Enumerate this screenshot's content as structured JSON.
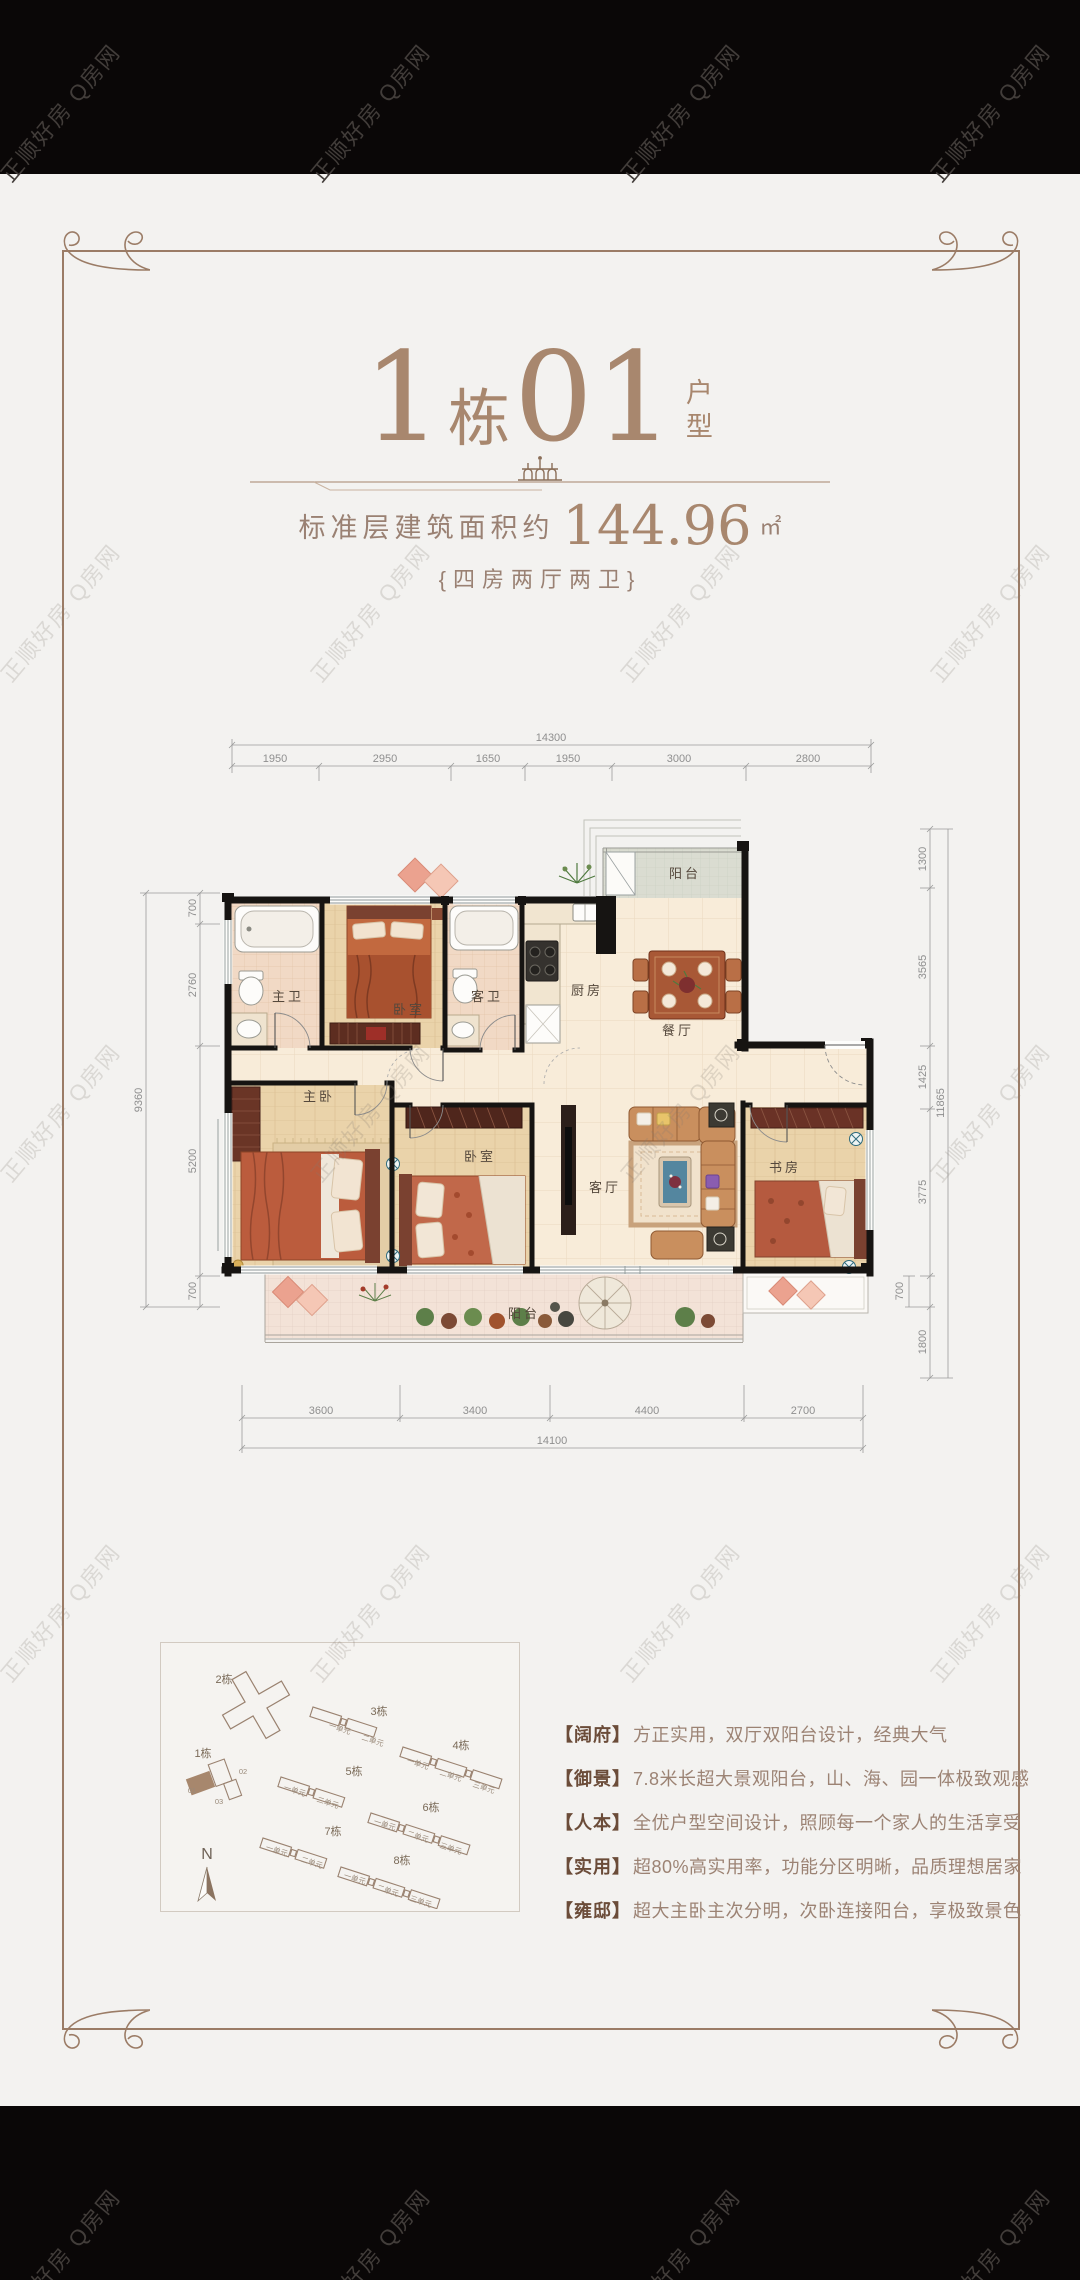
{
  "watermark": {
    "text": "正顺好房  Q房网"
  },
  "header": {
    "big1": "1",
    "unit_char": "栋",
    "big2": "01",
    "side_label": "户型",
    "area_prefix": "标准层建筑面积约",
    "area_value": "144.96",
    "area_unit": "㎡",
    "layout": "{四房两厅两卫}"
  },
  "floorplan": {
    "rooms": {
      "balcony_top": "阳台",
      "master_bath": "主卫",
      "bedroom2": "卧室",
      "guest_bath": "客卫",
      "kitchen": "厨房",
      "dining": "餐厅",
      "master_bedroom": "主卧",
      "bedroom3": "卧室",
      "living": "客厅",
      "study": "书房",
      "balcony_bottom": "阳台"
    },
    "dims_top": {
      "total": "14300",
      "segments": [
        "1950",
        "2950",
        "1650",
        "1950",
        "3000",
        "2800"
      ]
    },
    "dims_bottom": {
      "total": "14100",
      "segments": [
        "3600",
        "3400",
        "4400",
        "2700"
      ]
    },
    "dims_left": {
      "total": "9360",
      "segments": [
        "700",
        "2760",
        "5200",
        "700"
      ]
    },
    "dims_right": {
      "total": "11865",
      "segments": [
        "1300",
        "3565",
        "1425",
        "3775",
        "700",
        "1800"
      ]
    }
  },
  "siteplan": {
    "compass": "N",
    "buildings": [
      {
        "name": "2栋",
        "units": []
      },
      {
        "name": "1栋",
        "units": [
          "01",
          "02",
          "03"
        ]
      },
      {
        "name": "3栋",
        "units": [
          "一单元",
          "二单元"
        ]
      },
      {
        "name": "4栋",
        "units": [
          "一单元",
          "二单元",
          "三单元"
        ]
      },
      {
        "name": "5栋",
        "units": [
          "一单元",
          "二单元"
        ]
      },
      {
        "name": "6栋",
        "units": [
          "一单元",
          "二单元",
          "三单元"
        ]
      },
      {
        "name": "7栋",
        "units": [
          "一单元",
          "二单元"
        ]
      },
      {
        "name": "8栋",
        "units": [
          "一单元",
          "二单元",
          "三单元"
        ]
      }
    ]
  },
  "features": [
    {
      "tag": "【阔府】",
      "text": "方正实用，双厅双阳台设计，经典大气"
    },
    {
      "tag": "【御景】",
      "text": "7.8米长超大景观阳台，山、海、园一体极致观感"
    },
    {
      "tag": "【人本】",
      "text": "全优户型空间设计，照顾每一个家人的生活享受"
    },
    {
      "tag": "【实用】",
      "text": "超80%高实用率，功能分区明晰，品质理想居家"
    },
    {
      "tag": "【雍邸】",
      "text": "超大主卧主次分明，次卧连接阳台，享极致景色"
    }
  ]
}
